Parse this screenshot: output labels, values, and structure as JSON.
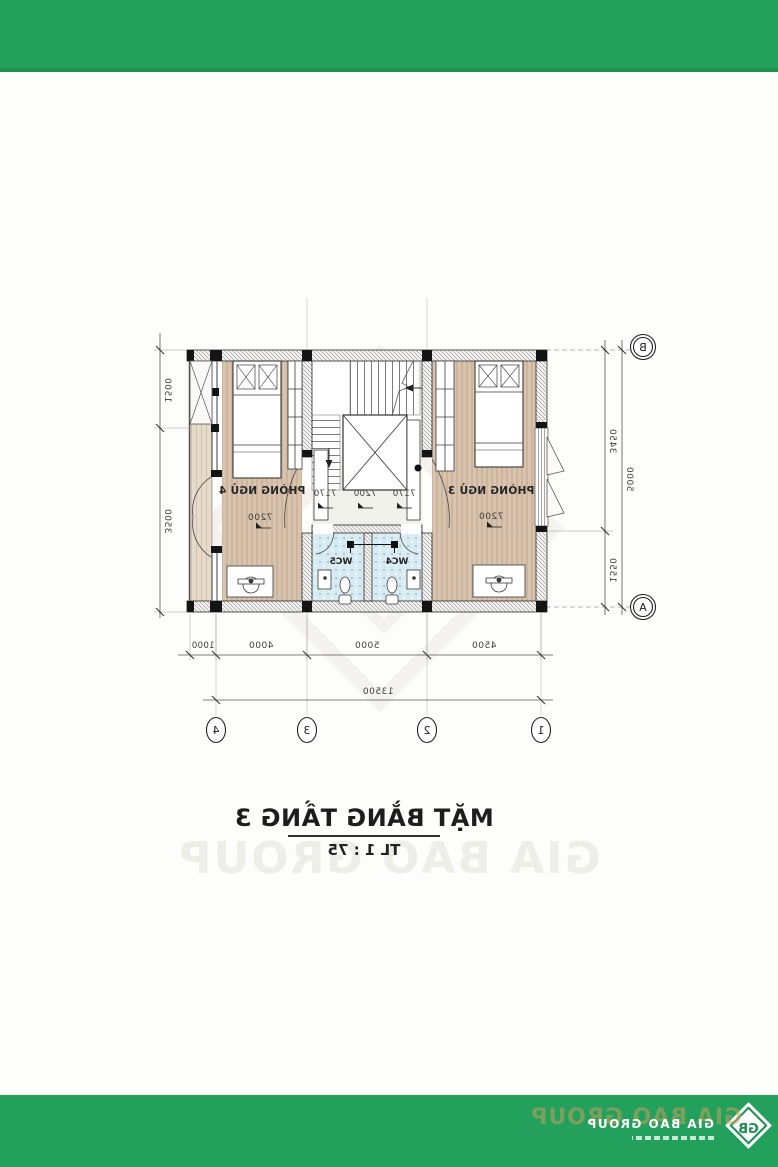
{
  "watermark": {
    "brand": "GIA BAO GROUP"
  },
  "plan": {
    "rooms": [
      {
        "id": "bedroom-3",
        "label": "PHÒNG NGỦ 3",
        "level": "7200"
      },
      {
        "id": "bedroom-4",
        "label": "PHÒNG NGỦ 4",
        "level": "7200"
      },
      {
        "id": "wc-4",
        "label": "WC4"
      },
      {
        "id": "wc-5",
        "label": "WC5"
      }
    ],
    "hall_levels": [
      "7170",
      "7200",
      "7170"
    ],
    "dimensions": {
      "bottom_segments": [
        "4500",
        "5000",
        "4000",
        "1000"
      ],
      "bottom_total": "13500",
      "side_segments": [
        "3450",
        "1550"
      ],
      "side_total": "5000",
      "balcony_side_segments": [
        "1500",
        "3500"
      ]
    },
    "grid": {
      "columns": [
        "1",
        "2",
        "3",
        "4"
      ],
      "rows": {
        "top": "B",
        "bottom": "A"
      }
    }
  },
  "title_block": {
    "title": "MẶT BẰNG TẦNG 3",
    "scale": "TL 1 : 75"
  },
  "footer_bar": {
    "brand": "GIA BAO GROUP",
    "monogram": "GB"
  },
  "colors": {
    "green": "#23a15c",
    "green_dark": "#1e9151",
    "wood": "#d8c3ae",
    "wood_light": "#e6dacb",
    "tile": "#d9ebf2",
    "tan_accent": "#c59a5d"
  }
}
